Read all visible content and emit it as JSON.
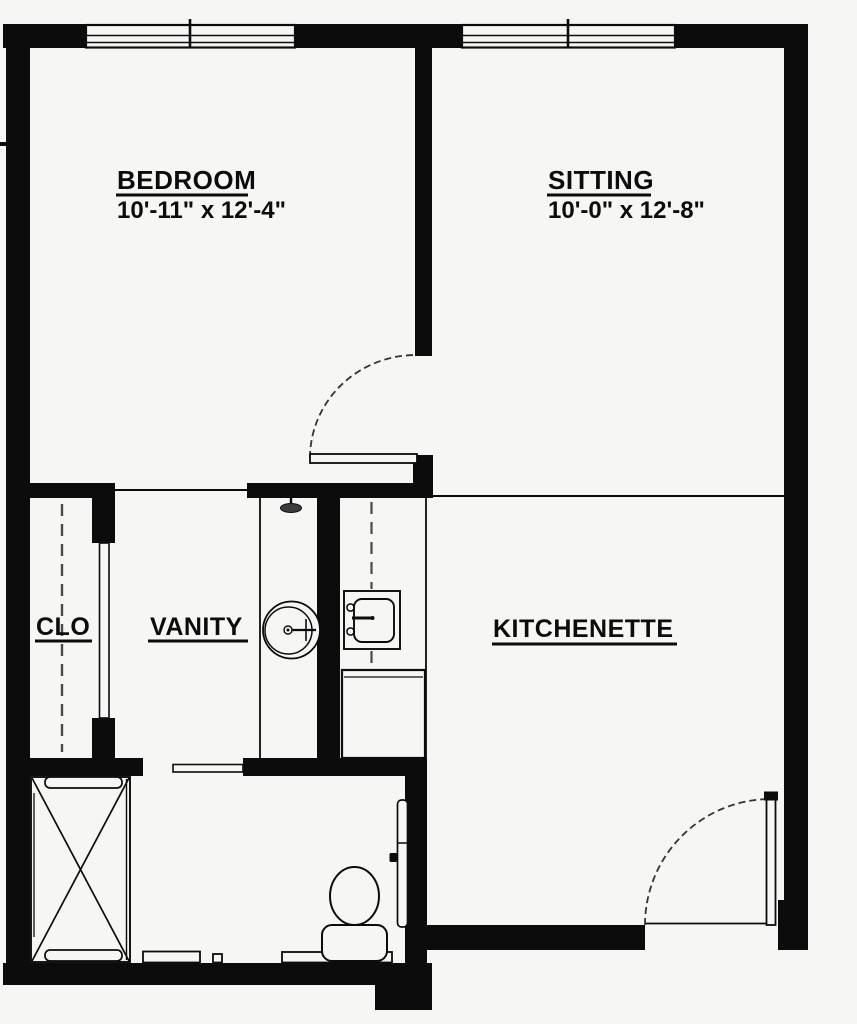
{
  "plan": {
    "type": "apartment-floor-plan",
    "background_color": "#f6f6f4",
    "wall_color": "#0c0c0c",
    "rooms": {
      "bedroom": {
        "label": "BEDROOM",
        "dimensions": "10'-11\" x 12'-4\""
      },
      "sitting": {
        "label": "SITTING",
        "dimensions": "10'-0\" x 12'-8\""
      },
      "closet": {
        "label": "CLO"
      },
      "vanity": {
        "label": "VANITY"
      },
      "kitchenette": {
        "label": "KITCHENETTE"
      }
    },
    "fixtures": [
      "window",
      "window",
      "bedroom-swing-door",
      "closet-door",
      "closet-rod",
      "vanity-counter",
      "vanity-round-sink",
      "shower-head",
      "kitchen-sink",
      "kitchen-counter",
      "refrigerator",
      "bathroom-sliding-door",
      "shower-stall",
      "grab-bar",
      "grab-bar",
      "toilet",
      "bathroom-door",
      "entry-swing-door"
    ]
  }
}
